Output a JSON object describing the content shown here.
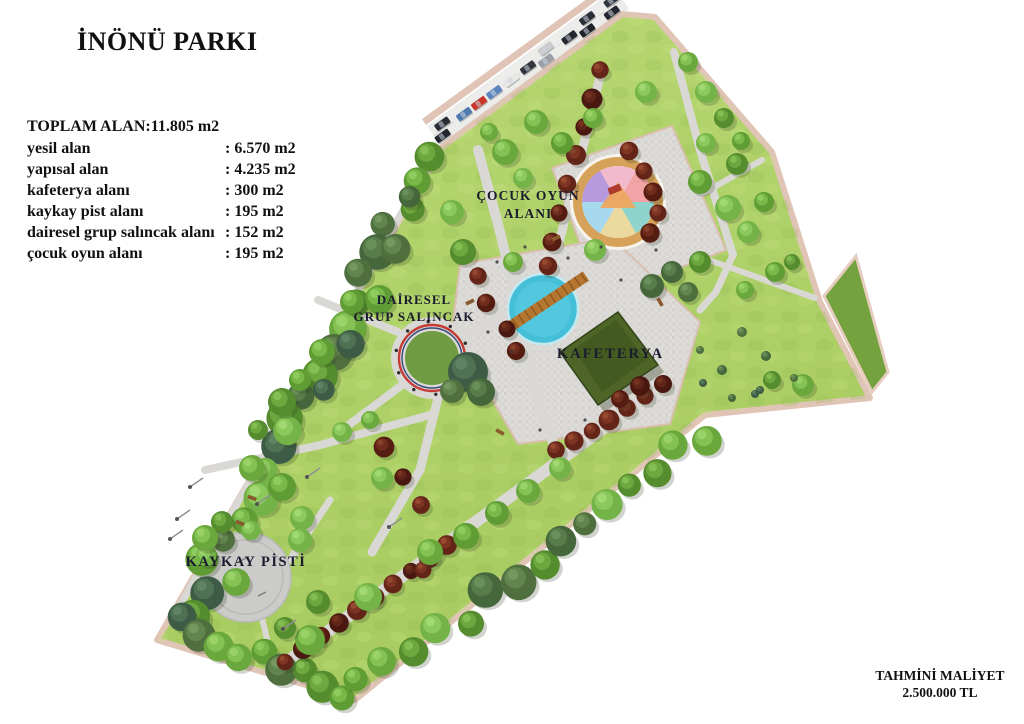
{
  "title": "İNÖNÜ PARKI",
  "stats": {
    "total": "TOPLAM ALAN:11.805 m2",
    "rows": [
      {
        "label": "yesil alan",
        "value": ": 6.570 m2"
      },
      {
        "label": "yapısal alan",
        "value": ": 4.235 m2"
      },
      {
        "label": "kafeterya alanı",
        "value": ": 300 m2"
      },
      {
        "label": "kaykay pist alanı",
        "value": ": 195 m2"
      },
      {
        "label": "dairesel grup salıncak alanı",
        "value": ": 152 m2"
      },
      {
        "label": "çocuk oyun alanı",
        "value": ": 195 m2"
      }
    ]
  },
  "map_labels": {
    "playground_line1": "ÇOCUK OYUN",
    "playground_line2": "ALANI",
    "swing_line1": "DAİRESEL",
    "swing_line2": "GRUP SALINCAK",
    "cafeteria": "KAFETERYA",
    "skate": "KAYKAY PİSTİ"
  },
  "footer": {
    "line1": "TAHMİNİ MALİYET",
    "line2": "2.500.000 TL"
  },
  "colors": {
    "lawn": "#b0d169",
    "dark_lawn": "#74a23e",
    "boundary_path": "#e0c4b6",
    "walkway": "#dad8d4",
    "pond": "#45bfd8",
    "bridge": "#b5772f",
    "playground_ring": "#d6a158",
    "cafeteria_roof": "#4e6527",
    "swing_ring": "#c43a34",
    "skate_rink": "#cbcbc9",
    "red_tree": "#5e2218",
    "label_ink": "#1b1b2e"
  }
}
